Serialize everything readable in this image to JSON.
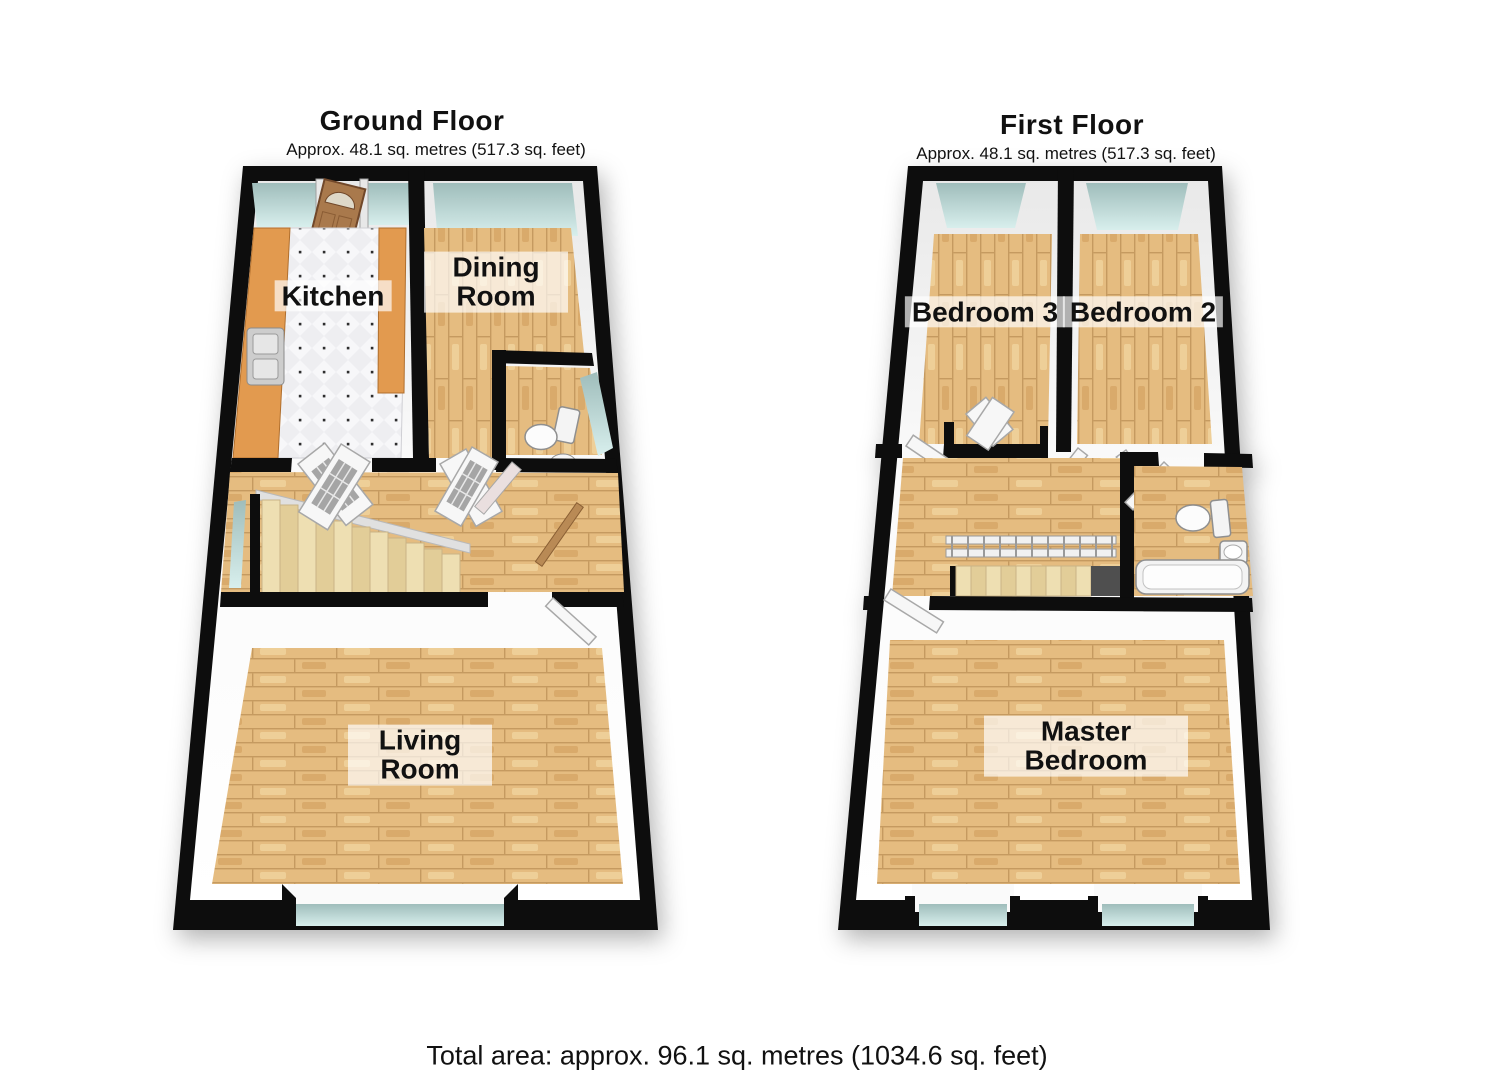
{
  "page": {
    "background_color": "#ffffff"
  },
  "floors": {
    "ground": {
      "title": "Ground Floor",
      "subtitle": "Approx. 48.1 sq. metres (517.3 sq. feet)",
      "rooms": {
        "kitchen": {
          "label": "Kitchen"
        },
        "dining": {
          "label": "Dining Room"
        },
        "living": {
          "label": "Living Room"
        }
      }
    },
    "first": {
      "title": "First Floor",
      "subtitle": "Approx. 48.1 sq. metres (517.3 sq. feet)",
      "rooms": {
        "bedroom3": {
          "label": "Bedroom 3"
        },
        "bedroom2": {
          "label": "Bedroom 2"
        },
        "master": {
          "label": "Master Bedroom"
        }
      }
    }
  },
  "footer": {
    "total_area": "Total area: approx. 96.1 sq. metres (1034.6 sq. feet)"
  },
  "colors": {
    "wall": "#0d0d0d",
    "floor_wood": "#e5bc80",
    "kitchen_counter": "#e29a4f",
    "kitchen_tile": "#eeeef1",
    "window_glass": "#c9e6e4",
    "stairs": "#ead8aa",
    "front_door": "#a9794c",
    "label_text": "#111111",
    "label_background": "rgba(255,255,255,0.68)"
  }
}
